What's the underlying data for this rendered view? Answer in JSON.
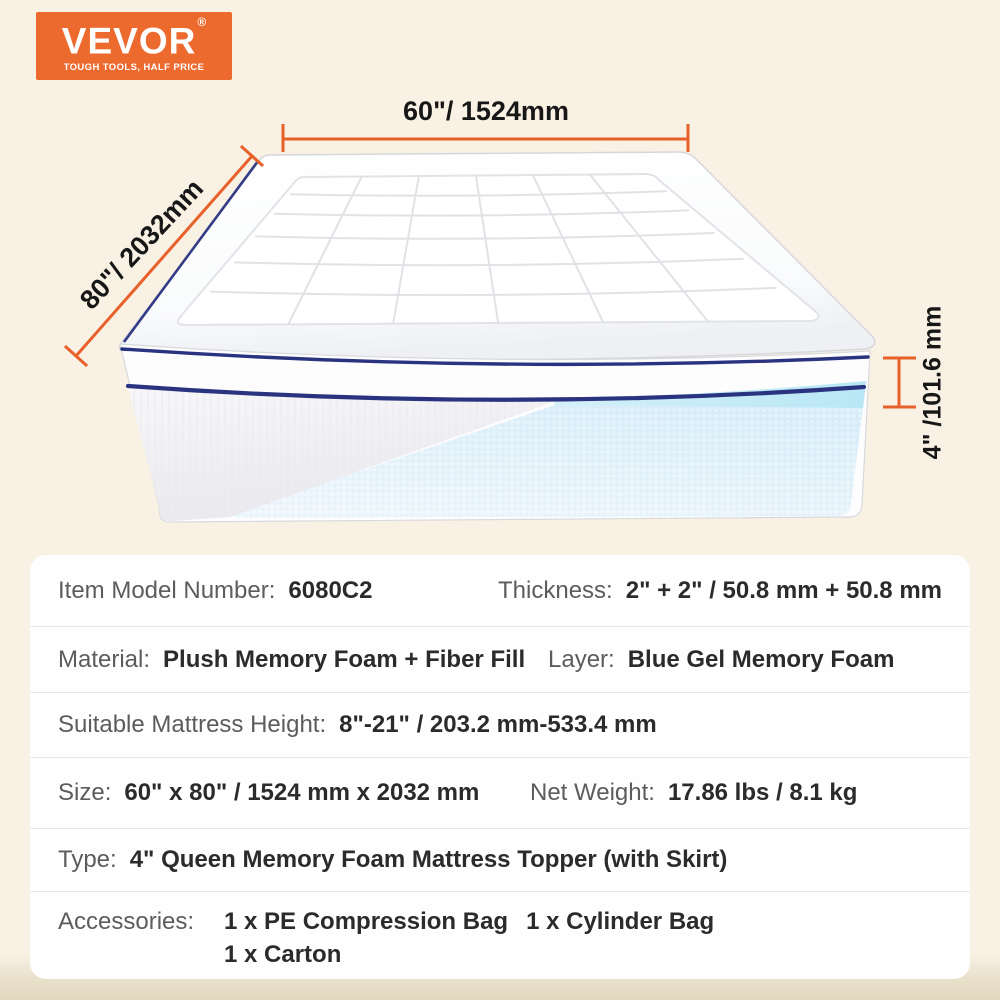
{
  "brand": {
    "name": "VEVOR",
    "registered": "®",
    "tagline": "TOUGH TOOLS, HALF PRICE",
    "brand_color": "#ED6A2F"
  },
  "diagram": {
    "width_label": "60\"/ 1524mm",
    "depth_label": "80\"/ 2032mm",
    "height_label": "4\" /101.6 mm",
    "dimension_line_color": "#E8602A",
    "piping_color": "#2A3380",
    "gel_color": "#C3EBF6"
  },
  "specs": {
    "rows": [
      {
        "pairs": [
          {
            "label": "Item Model Number:",
            "value": "6080C2"
          },
          {
            "label": "Thickness:",
            "value": "2\" + 2\" / 50.8 mm + 50.8 mm"
          }
        ]
      },
      {
        "pairs": [
          {
            "label": "Material:",
            "value": "Plush Memory Foam + Fiber Fill"
          },
          {
            "label": "Layer:",
            "value": "Blue Gel Memory Foam"
          }
        ]
      },
      {
        "pairs": [
          {
            "label": "Suitable Mattress Height:",
            "value": "8\"-21\" / 203.2 mm-533.4 mm"
          }
        ]
      },
      {
        "pairs": [
          {
            "label": "Size:",
            "value": "60\" x 80\" / 1524 mm x 2032 mm"
          },
          {
            "label": "Net Weight:",
            "value": "17.86 lbs / 8.1 kg"
          }
        ]
      },
      {
        "pairs": [
          {
            "label": "Type:",
            "value": "4\" Queen Memory Foam Mattress Topper (with Skirt)"
          }
        ]
      },
      {
        "label": "Accessories:",
        "line1": [
          "1 x PE Compression Bag",
          "1 x Cylinder Bag"
        ],
        "line2": "1 x Carton"
      }
    ]
  }
}
